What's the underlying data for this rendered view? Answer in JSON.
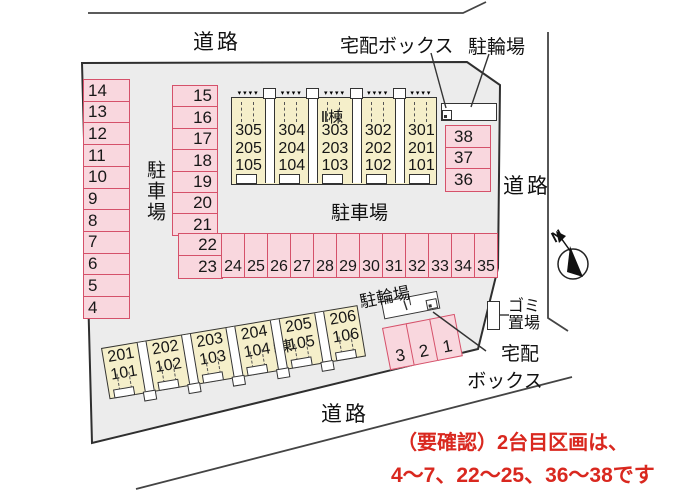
{
  "colors": {
    "site_fill": "#ececec",
    "outline": "#333333",
    "cell_fill": "#f9d7de",
    "cell_border": "#d5516a",
    "building_fill": "#f5efca",
    "note_red": "#d9281f"
  },
  "icons": {
    "triangle": "▾",
    "north_needle": "compass-needle"
  },
  "labels": {
    "road_top": "道路",
    "road_right": "道路",
    "road_bottom": "道路",
    "delivery_top": "宅配ボックス",
    "bike_top": "駐輪場",
    "parking_left": "駐車場",
    "parking_center": "駐車場",
    "bike_bottom": "駐輪場",
    "delivery_bottom_1": "宅配",
    "delivery_bottom_2": "ボックス",
    "garbage_1": "ゴミ",
    "garbage_2": "置場",
    "north": "N"
  },
  "buildings": {
    "b2": {
      "name": "Ⅱ棟",
      "units": [
        [
          "305",
          "205",
          "105"
        ],
        [
          "304",
          "204",
          "104"
        ],
        [
          "303",
          "203",
          "103"
        ],
        [
          "302",
          "202",
          "102"
        ],
        [
          "301",
          "201",
          "101"
        ]
      ]
    },
    "b1": {
      "name": "Ⅰ棟",
      "units": [
        [
          "201",
          "101"
        ],
        [
          "202",
          "102"
        ],
        [
          "203",
          "103"
        ],
        [
          "204",
          "104"
        ],
        [
          "205",
          "105"
        ],
        [
          "206",
          "106"
        ]
      ]
    }
  },
  "parking": {
    "left_column": [
      "14",
      "13",
      "12",
      "11",
      "10",
      "9",
      "8",
      "7",
      "6",
      "5",
      "4"
    ],
    "mid_column": [
      "15",
      "16",
      "17",
      "18",
      "19",
      "20",
      "21"
    ],
    "mid_column_lower": [
      "22",
      "23"
    ],
    "bottom_row": [
      "24",
      "25",
      "26",
      "27",
      "28",
      "29",
      "30",
      "31",
      "32",
      "33",
      "34",
      "35"
    ],
    "right_column": [
      "38",
      "37",
      "36"
    ],
    "tilted_row": [
      "3",
      "2",
      "1"
    ]
  },
  "note": {
    "line1": "（要確認）2台目区画は、",
    "line2": "4〜7、22〜25、36〜38です"
  }
}
